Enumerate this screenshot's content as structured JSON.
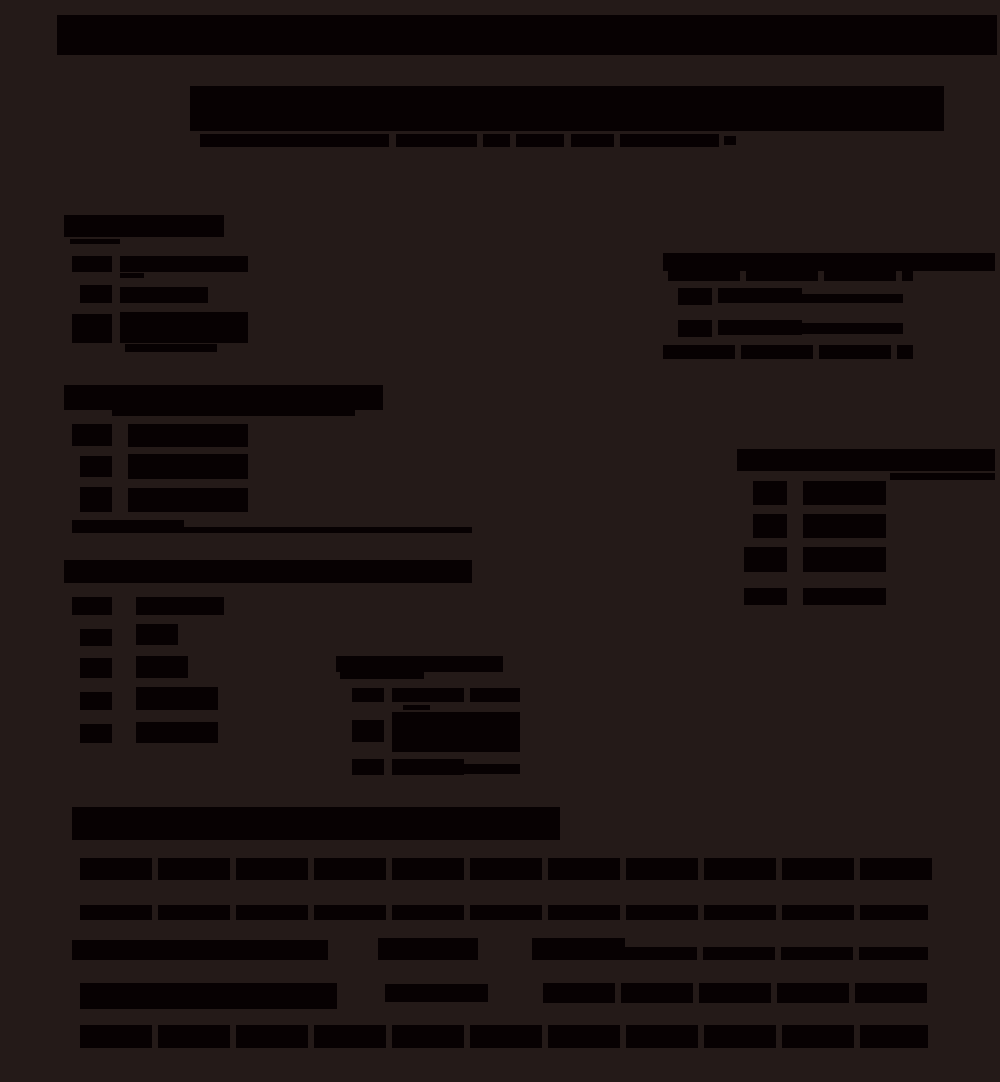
{
  "page": {
    "width": 1000,
    "height": 1082,
    "background_color": "#241a18",
    "ink_color": "#070102",
    "legible_text": "",
    "description_visible_content": "document with fully black (redacted-looking) text blocks on dark background"
  },
  "blocks": [
    {
      "name": "top-banner-bar",
      "kind": "bar",
      "x": 57,
      "y": 15,
      "w": 940,
      "h": 40,
      "interactable": false
    },
    {
      "name": "doc-title-block",
      "kind": "bar",
      "x": 190,
      "y": 86,
      "w": 754,
      "h": 45,
      "interactable": false
    },
    {
      "name": "subtitle-seg-1",
      "kind": "bar",
      "x": 200,
      "y": 134,
      "w": 189,
      "h": 13,
      "interactable": false
    },
    {
      "name": "subtitle-seg-2",
      "kind": "bar",
      "x": 396,
      "y": 134,
      "w": 81,
      "h": 13,
      "interactable": false
    },
    {
      "name": "subtitle-seg-3",
      "kind": "bar",
      "x": 483,
      "y": 134,
      "w": 27,
      "h": 13,
      "interactable": false
    },
    {
      "name": "subtitle-seg-4",
      "kind": "bar",
      "x": 516,
      "y": 134,
      "w": 48,
      "h": 13,
      "interactable": false
    },
    {
      "name": "subtitle-seg-5",
      "kind": "bar",
      "x": 571,
      "y": 134,
      "w": 43,
      "h": 13,
      "interactable": false
    },
    {
      "name": "subtitle-seg-6",
      "kind": "bar",
      "x": 620,
      "y": 134,
      "w": 99,
      "h": 13,
      "interactable": false
    },
    {
      "name": "subtitle-seg-7",
      "kind": "bar",
      "x": 724,
      "y": 136,
      "w": 12,
      "h": 9,
      "interactable": false
    },
    {
      "name": "section1-header-bar",
      "kind": "bar",
      "x": 64,
      "y": 215,
      "w": 160,
      "h": 22,
      "interactable": false
    },
    {
      "name": "section1-header-note",
      "kind": "rule",
      "x": 70,
      "y": 239,
      "w": 50,
      "h": 5,
      "interactable": false
    },
    {
      "name": "section1-item1-box",
      "kind": "box",
      "x": 72,
      "y": 256,
      "w": 40,
      "h": 16,
      "interactable": false
    },
    {
      "name": "section1-item1-text",
      "kind": "bar",
      "x": 120,
      "y": 256,
      "w": 128,
      "h": 16,
      "interactable": false
    },
    {
      "name": "section1-item1-note",
      "kind": "rule",
      "x": 120,
      "y": 273,
      "w": 24,
      "h": 5,
      "interactable": false
    },
    {
      "name": "section1-item2-box",
      "kind": "box",
      "x": 80,
      "y": 285,
      "w": 32,
      "h": 18,
      "interactable": false
    },
    {
      "name": "section1-item2-text",
      "kind": "bar",
      "x": 120,
      "y": 287,
      "w": 88,
      "h": 16,
      "interactable": false
    },
    {
      "name": "section1-item3-box",
      "kind": "box",
      "x": 72,
      "y": 314,
      "w": 40,
      "h": 29,
      "interactable": false
    },
    {
      "name": "section1-item3-text",
      "kind": "bar",
      "x": 120,
      "y": 312,
      "w": 128,
      "h": 31,
      "interactable": false
    },
    {
      "name": "section1-item3-note",
      "kind": "rule",
      "x": 125,
      "y": 344,
      "w": 92,
      "h": 8,
      "interactable": false
    },
    {
      "name": "right-section-header-bar",
      "kind": "bar",
      "x": 663,
      "y": 253,
      "w": 332,
      "h": 18,
      "interactable": false
    },
    {
      "name": "right-section-subheader-line",
      "kind": "text",
      "x": 668,
      "y": 271,
      "w": 245,
      "h": 10,
      "interactable": false
    },
    {
      "name": "right-option1-box",
      "kind": "box",
      "x": 678,
      "y": 288,
      "w": 34,
      "h": 17,
      "interactable": false
    },
    {
      "name": "right-option1-text",
      "kind": "bar",
      "x": 718,
      "y": 288,
      "w": 84,
      "h": 15,
      "interactable": false
    },
    {
      "name": "right-option1-line",
      "kind": "rule",
      "x": 802,
      "y": 294,
      "w": 101,
      "h": 9,
      "interactable": false
    },
    {
      "name": "right-option2-box",
      "kind": "box",
      "x": 678,
      "y": 320,
      "w": 34,
      "h": 17,
      "interactable": false
    },
    {
      "name": "right-option2-text",
      "kind": "bar",
      "x": 718,
      "y": 320,
      "w": 84,
      "h": 15,
      "interactable": false
    },
    {
      "name": "right-option2-line",
      "kind": "rule",
      "x": 802,
      "y": 323,
      "w": 101,
      "h": 11,
      "interactable": false
    },
    {
      "name": "right-section-footnote-line",
      "kind": "text",
      "x": 663,
      "y": 345,
      "w": 250,
      "h": 14,
      "interactable": false
    },
    {
      "name": "section2-header-bar",
      "kind": "bar",
      "x": 64,
      "y": 385,
      "w": 319,
      "h": 25,
      "interactable": false
    },
    {
      "name": "section2-header-subline",
      "kind": "rule",
      "x": 112,
      "y": 410,
      "w": 243,
      "h": 6,
      "interactable": false
    },
    {
      "name": "section2-itemA-box",
      "kind": "box",
      "x": 72,
      "y": 424,
      "w": 40,
      "h": 22,
      "interactable": false
    },
    {
      "name": "section2-itemA-text",
      "kind": "bar",
      "x": 128,
      "y": 424,
      "w": 120,
      "h": 23,
      "interactable": false
    },
    {
      "name": "section2-itemB-box",
      "kind": "box",
      "x": 80,
      "y": 456,
      "w": 32,
      "h": 21,
      "interactable": false
    },
    {
      "name": "section2-itemB-text",
      "kind": "bar",
      "x": 128,
      "y": 454,
      "w": 120,
      "h": 25,
      "interactable": false
    },
    {
      "name": "section2-itemC-box",
      "kind": "box",
      "x": 80,
      "y": 487,
      "w": 32,
      "h": 25,
      "interactable": false
    },
    {
      "name": "section2-itemC-text",
      "kind": "bar",
      "x": 128,
      "y": 488,
      "w": 120,
      "h": 24,
      "interactable": false
    },
    {
      "name": "section2-note-text",
      "kind": "bar",
      "x": 72,
      "y": 520,
      "w": 112,
      "h": 13,
      "interactable": false
    },
    {
      "name": "section2-note-rule",
      "kind": "rule",
      "x": 184,
      "y": 527,
      "w": 288,
      "h": 6,
      "interactable": false
    },
    {
      "name": "table-header-bar",
      "kind": "bar",
      "x": 737,
      "y": 449,
      "w": 258,
      "h": 22,
      "interactable": false
    },
    {
      "name": "table-header-subline",
      "kind": "rule",
      "x": 890,
      "y": 473,
      "w": 105,
      "h": 7,
      "interactable": false
    },
    {
      "name": "table-row1-label-box",
      "kind": "box",
      "x": 753,
      "y": 481,
      "w": 34,
      "h": 24,
      "interactable": false
    },
    {
      "name": "table-row1-value",
      "kind": "bar",
      "x": 803,
      "y": 481,
      "w": 83,
      "h": 24,
      "interactable": false
    },
    {
      "name": "table-row2-label-box",
      "kind": "box",
      "x": 753,
      "y": 514,
      "w": 34,
      "h": 24,
      "interactable": false
    },
    {
      "name": "table-row2-value",
      "kind": "bar",
      "x": 803,
      "y": 514,
      "w": 83,
      "h": 24,
      "interactable": false
    },
    {
      "name": "table-row3-label-box",
      "kind": "box",
      "x": 744,
      "y": 547,
      "w": 43,
      "h": 25,
      "interactable": false
    },
    {
      "name": "table-row3-value",
      "kind": "bar",
      "x": 803,
      "y": 547,
      "w": 83,
      "h": 25,
      "interactable": false
    },
    {
      "name": "table-row4-label-box",
      "kind": "box",
      "x": 744,
      "y": 588,
      "w": 43,
      "h": 17,
      "interactable": false
    },
    {
      "name": "table-row4-value",
      "kind": "bar",
      "x": 803,
      "y": 588,
      "w": 83,
      "h": 17,
      "interactable": false
    },
    {
      "name": "section3-header-bar",
      "kind": "bar",
      "x": 64,
      "y": 560,
      "w": 408,
      "h": 23,
      "interactable": false
    },
    {
      "name": "section3-item1-box",
      "kind": "box",
      "x": 72,
      "y": 597,
      "w": 40,
      "h": 18,
      "interactable": false
    },
    {
      "name": "section3-item1-text",
      "kind": "bar",
      "x": 136,
      "y": 597,
      "w": 88,
      "h": 18,
      "interactable": false
    },
    {
      "name": "section3-item2-box",
      "kind": "box",
      "x": 80,
      "y": 629,
      "w": 32,
      "h": 17,
      "interactable": false
    },
    {
      "name": "section3-item2-text",
      "kind": "bar",
      "x": 136,
      "y": 624,
      "w": 42,
      "h": 21,
      "interactable": false
    },
    {
      "name": "section3-item3-box",
      "kind": "box",
      "x": 80,
      "y": 658,
      "w": 32,
      "h": 20,
      "interactable": false
    },
    {
      "name": "section3-item3-text",
      "kind": "bar",
      "x": 136,
      "y": 656,
      "w": 52,
      "h": 22,
      "interactable": false
    },
    {
      "name": "section3-item4-box",
      "kind": "box",
      "x": 80,
      "y": 692,
      "w": 32,
      "h": 18,
      "interactable": false
    },
    {
      "name": "section3-item4-text",
      "kind": "bar",
      "x": 136,
      "y": 687,
      "w": 82,
      "h": 23,
      "interactable": false
    },
    {
      "name": "section3-item5-box",
      "kind": "box",
      "x": 80,
      "y": 724,
      "w": 32,
      "h": 19,
      "interactable": false
    },
    {
      "name": "section3-item5-text",
      "kind": "bar",
      "x": 136,
      "y": 722,
      "w": 82,
      "h": 21,
      "interactable": false
    },
    {
      "name": "subsection-header-bar",
      "kind": "bar",
      "x": 336,
      "y": 656,
      "w": 167,
      "h": 16,
      "interactable": false
    },
    {
      "name": "subsection-header-note",
      "kind": "rule",
      "x": 340,
      "y": 672,
      "w": 84,
      "h": 7,
      "interactable": false
    },
    {
      "name": "subsection-item1-box",
      "kind": "box",
      "x": 352,
      "y": 688,
      "w": 32,
      "h": 14,
      "interactable": false
    },
    {
      "name": "subsection-item1-text",
      "kind": "text",
      "x": 392,
      "y": 688,
      "w": 128,
      "h": 14,
      "interactable": false
    },
    {
      "name": "subsection-item2-pre",
      "kind": "rule",
      "x": 403,
      "y": 705,
      "w": 27,
      "h": 5,
      "interactable": false
    },
    {
      "name": "subsection-item2-box",
      "kind": "box",
      "x": 352,
      "y": 720,
      "w": 32,
      "h": 22,
      "interactable": false
    },
    {
      "name": "subsection-item2-text",
      "kind": "bar",
      "x": 392,
      "y": 712,
      "w": 128,
      "h": 40,
      "interactable": false
    },
    {
      "name": "subsection-item3-box",
      "kind": "box",
      "x": 352,
      "y": 759,
      "w": 32,
      "h": 16,
      "interactable": false
    },
    {
      "name": "subsection-item3-text",
      "kind": "bar",
      "x": 392,
      "y": 759,
      "w": 72,
      "h": 16,
      "interactable": false
    },
    {
      "name": "subsection-item3-line",
      "kind": "rule",
      "x": 464,
      "y": 764,
      "w": 56,
      "h": 10,
      "interactable": false
    },
    {
      "name": "bottom-header-bar",
      "kind": "bar",
      "x": 72,
      "y": 807,
      "w": 488,
      "h": 33,
      "interactable": false
    },
    {
      "name": "bottom-line1",
      "kind": "text",
      "x": 80,
      "y": 858,
      "w": 857,
      "h": 22,
      "interactable": false
    },
    {
      "name": "bottom-line2",
      "kind": "text",
      "x": 80,
      "y": 905,
      "w": 848,
      "h": 15,
      "interactable": false
    },
    {
      "name": "bottom-row1-seg1",
      "kind": "bar",
      "x": 72,
      "y": 940,
      "w": 256,
      "h": 20,
      "interactable": false
    },
    {
      "name": "bottom-row1-seg2",
      "kind": "bar",
      "x": 378,
      "y": 938,
      "w": 100,
      "h": 22,
      "interactable": false
    },
    {
      "name": "bottom-row1-seg3",
      "kind": "bar",
      "x": 532,
      "y": 938,
      "w": 93,
      "h": 22,
      "interactable": false
    },
    {
      "name": "bottom-row1-line",
      "kind": "text",
      "x": 625,
      "y": 947,
      "w": 303,
      "h": 13,
      "interactable": false
    },
    {
      "name": "bottom-row2-seg1",
      "kind": "bar",
      "x": 80,
      "y": 983,
      "w": 257,
      "h": 26,
      "interactable": false
    },
    {
      "name": "bottom-row2-seg2",
      "kind": "bar",
      "x": 385,
      "y": 984,
      "w": 103,
      "h": 18,
      "interactable": false
    },
    {
      "name": "bottom-row2-seg3",
      "kind": "text",
      "x": 543,
      "y": 983,
      "w": 385,
      "h": 20,
      "interactable": false
    },
    {
      "name": "bottom-line3",
      "kind": "text",
      "x": 80,
      "y": 1025,
      "w": 848,
      "h": 23,
      "interactable": false
    }
  ]
}
